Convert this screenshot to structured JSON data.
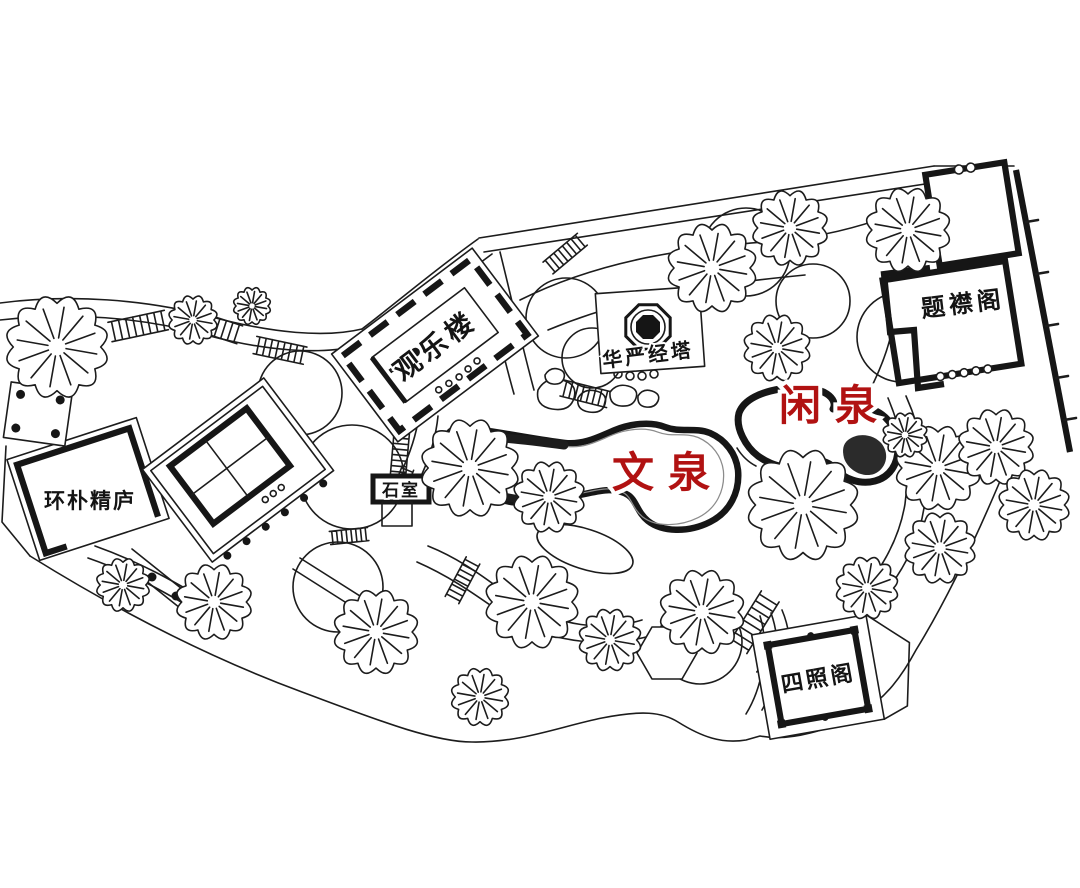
{
  "map": {
    "type": "garden-site-plan",
    "colors": {
      "background": "#ffffff",
      "ink": "#1c1c1c",
      "spring_label_red": "#b11212"
    },
    "labels": {
      "guanlelou": "观乐楼",
      "huayanjingta": "华严经塔",
      "tijinge": "题襟阁",
      "xianquan": "闲泉",
      "wenquan": "文泉",
      "huanpujinglu": "环朴精庐",
      "shishi": "石室",
      "sizhaoge": "四照阁"
    }
  }
}
